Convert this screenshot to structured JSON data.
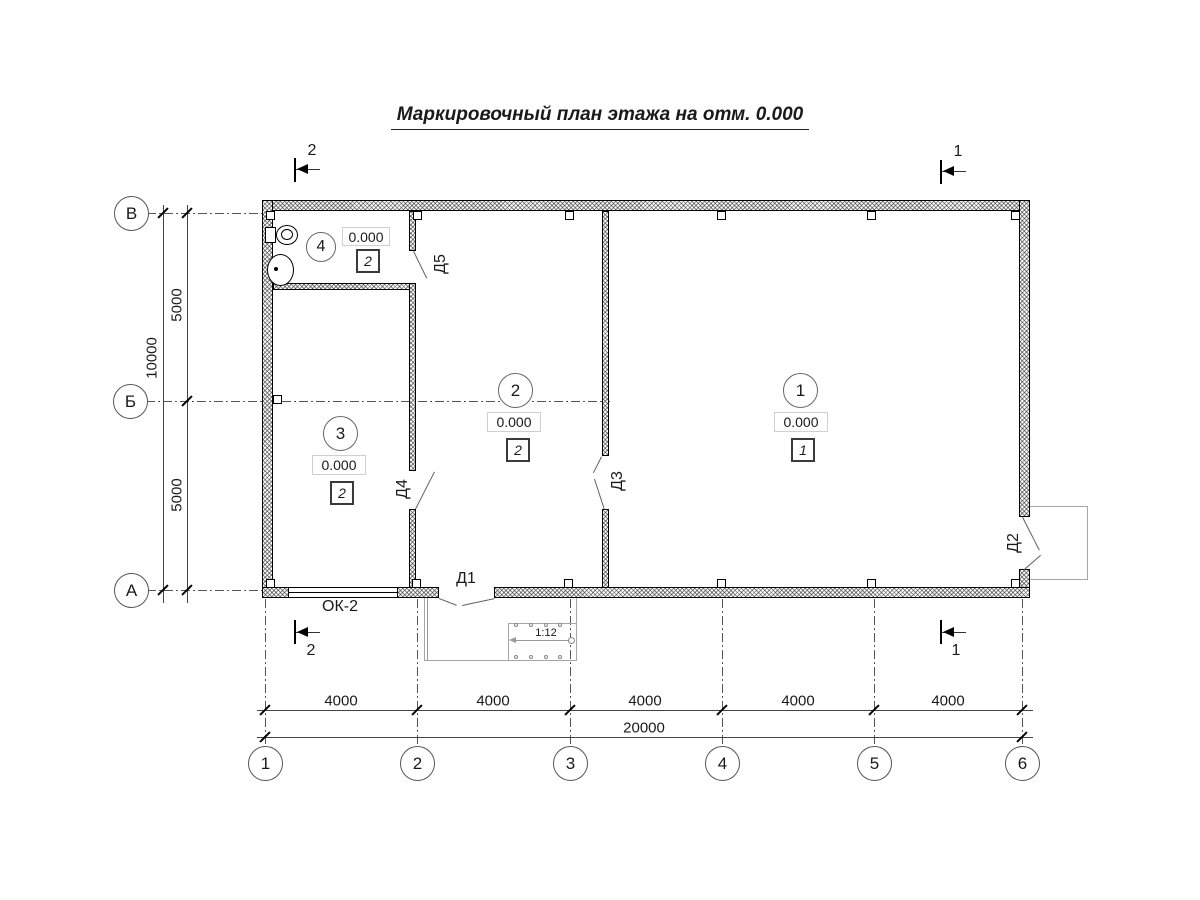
{
  "title": "Маркировочный план этажа на отм. 0.000",
  "axes": {
    "rows": [
      "В",
      "Б",
      "А"
    ],
    "cols": [
      "1",
      "2",
      "3",
      "4",
      "5",
      "6"
    ]
  },
  "dims": {
    "left_overall": "10000",
    "left_segments": [
      "5000",
      "5000"
    ],
    "bottom_overall": "20000",
    "bottom_segments": [
      "4000",
      "4000",
      "4000",
      "4000",
      "4000"
    ]
  },
  "rooms": [
    {
      "number": "1",
      "elevation": "0.000",
      "type": "1"
    },
    {
      "number": "2",
      "elevation": "0.000",
      "type": "2"
    },
    {
      "number": "3",
      "elevation": "0.000",
      "type": "2"
    },
    {
      "number": "4",
      "elevation": "0.000",
      "type": "2"
    }
  ],
  "doors": [
    "Д1",
    "Д2",
    "Д3",
    "Д4",
    "Д5"
  ],
  "window": {
    "label": "ОК-2"
  },
  "ramp": {
    "slope": "1:12"
  },
  "sections": {
    "mark1": "1",
    "mark2": "2"
  },
  "colors": {
    "line": "#000000",
    "hatch": "#8a8a8a",
    "construction": "#9a9a9a"
  }
}
